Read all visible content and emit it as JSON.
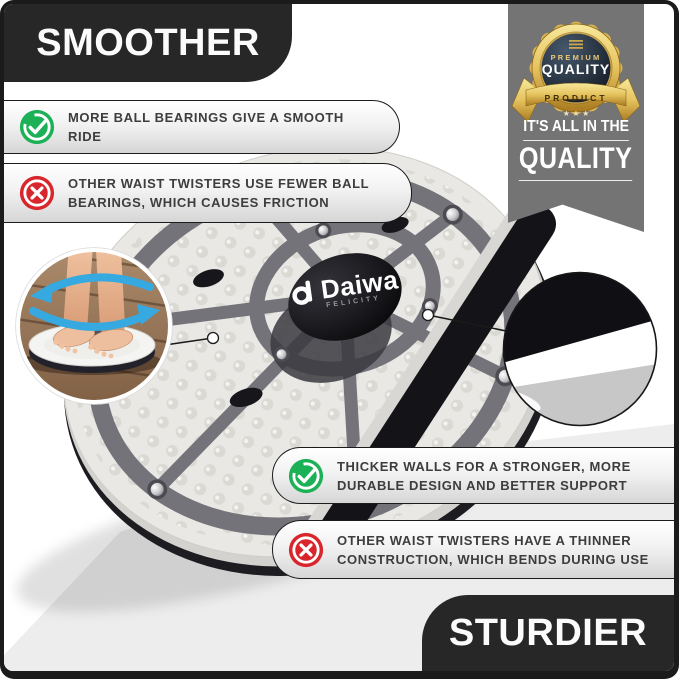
{
  "banners": {
    "smoother": "SMOOTHER",
    "sturdier": "STURDIER"
  },
  "quality_ribbon": {
    "line1": "IT'S ALL IN THE",
    "line2": "QUALITY",
    "badge": {
      "premium": "PREMIUM",
      "quality": "QUALITY",
      "product": "PRODUCT",
      "stars": "★ ★ ★"
    }
  },
  "callouts": {
    "smooth_pro": {
      "lines": [
        "MORE BALL BEARINGS GIVE A SMOOTH RIDE"
      ]
    },
    "smooth_con": {
      "lines": [
        "OTHER WAIST TWISTERS USE FEWER BALL",
        "BEARINGS, WHICH CAUSES FRICTION"
      ]
    },
    "sturdy_pro": {
      "lines": [
        "THICKER WALLS FOR A STRONGER, MORE",
        "DURABLE DESIGN AND BETTER SUPPORT"
      ]
    },
    "sturdy_con": {
      "lines": [
        "OTHER WAIST TWISTERS HAVE A THINNER",
        "CONSTRUCTION, WHICH BENDS DURING USE"
      ]
    }
  },
  "product": {
    "brand": "Daiwa",
    "brand_sub": "FELICITY"
  },
  "colors": {
    "banner_black": "#272727",
    "ribbon_gray": "#747474",
    "pro_green": "#1db157",
    "con_red": "#d8262c",
    "arrow_blue": "#36a9e1",
    "badge_gold": "#e6c35f",
    "plate_gray": "#e9e8e4",
    "frame_gray": "#74737a"
  }
}
